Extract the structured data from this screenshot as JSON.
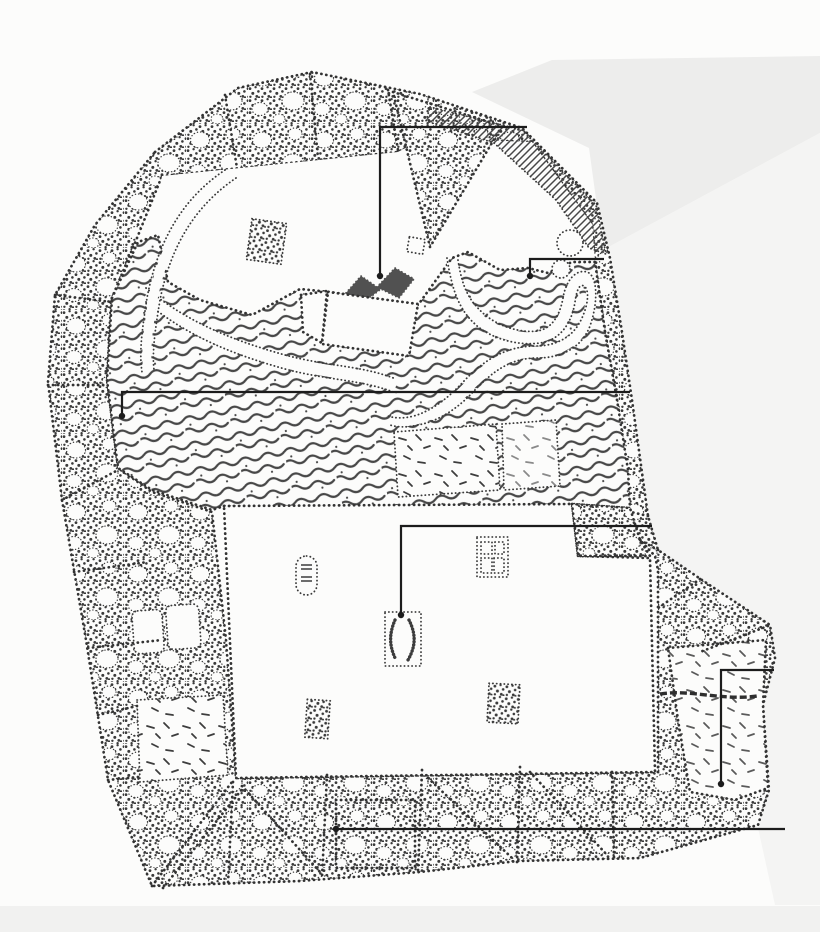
{
  "image": {
    "kind": "scanned stippled ink site plan of a walled garden, no text labels",
    "width": 820,
    "height": 932
  },
  "colors": {
    "paper": "#fcfcfb",
    "ink": "#1c1c1c",
    "stipple": "#3a3a3a",
    "scan_shadow_dark": "#ededec",
    "scan_shadow_light": "#f4f4f3",
    "bottom_strip": "#f1f1f0"
  },
  "map": {
    "callouts": [
      {
        "id": 1,
        "target": "north-lake-boat-pavilion",
        "points": [
          [
            527,
            127
          ],
          [
            380,
            127
          ],
          [
            380,
            276
          ]
        ],
        "dot": [
          380,
          276
        ]
      },
      {
        "id": 2,
        "target": "northeast-stream-bank",
        "points": [
          [
            604,
            259
          ],
          [
            530,
            259
          ],
          [
            530,
            276
          ]
        ],
        "dot": [
          530,
          276
        ]
      },
      {
        "id": 3,
        "target": "west-rockery-band",
        "points": [
          [
            630,
            392
          ],
          [
            122,
            392
          ],
          [
            122,
            416
          ]
        ],
        "dot": [
          122,
          416
        ]
      },
      {
        "id": 4,
        "target": "central-court-pavilion",
        "points": [
          [
            652,
            526
          ],
          [
            401,
            526
          ],
          [
            401,
            615
          ]
        ],
        "dot": [
          401,
          615
        ]
      },
      {
        "id": 5,
        "target": "southeast-yard",
        "points": [
          [
            774,
            670
          ],
          [
            721,
            670
          ],
          [
            721,
            784
          ]
        ],
        "dot": [
          721,
          784
        ]
      },
      {
        "id": 6,
        "target": "south-grove-band",
        "points": [
          [
            785,
            829
          ],
          [
            336,
            829
          ]
        ],
        "dot": [
          336,
          829
        ]
      }
    ],
    "features": [
      {
        "name": "island-grove",
        "kind": "stipple-rect",
        "x": 249,
        "y": 221,
        "w": 35,
        "h": 41,
        "rot": 8
      },
      {
        "name": "lakeside-plot",
        "kind": "dotted-rect",
        "x": 408,
        "y": 238,
        "w": 16,
        "h": 15,
        "rot": 10
      },
      {
        "name": "oval-terrace",
        "kind": "stadium",
        "x": 296,
        "y": 556,
        "w": 21,
        "h": 39
      },
      {
        "name": "paved-square",
        "kind": "window",
        "x": 477,
        "y": 537,
        "w": 31,
        "h": 40
      },
      {
        "name": "central-court-pavilion",
        "kind": "pavilion",
        "x": 385,
        "y": 612,
        "w": 36,
        "h": 54
      },
      {
        "name": "southwest-plot",
        "kind": "stipple-rect",
        "x": 306,
        "y": 700,
        "w": 23,
        "h": 38,
        "rot": 4
      },
      {
        "name": "southeast-plot",
        "kind": "stipple-rect",
        "x": 488,
        "y": 684,
        "w": 31,
        "h": 39,
        "rot": 3
      },
      {
        "name": "lakeside-tree-large",
        "kind": "tree",
        "x": 570,
        "y": 243,
        "r": 13
      },
      {
        "name": "lakeside-tree-small",
        "kind": "tree",
        "x": 561,
        "y": 269,
        "r": 9
      }
    ]
  }
}
